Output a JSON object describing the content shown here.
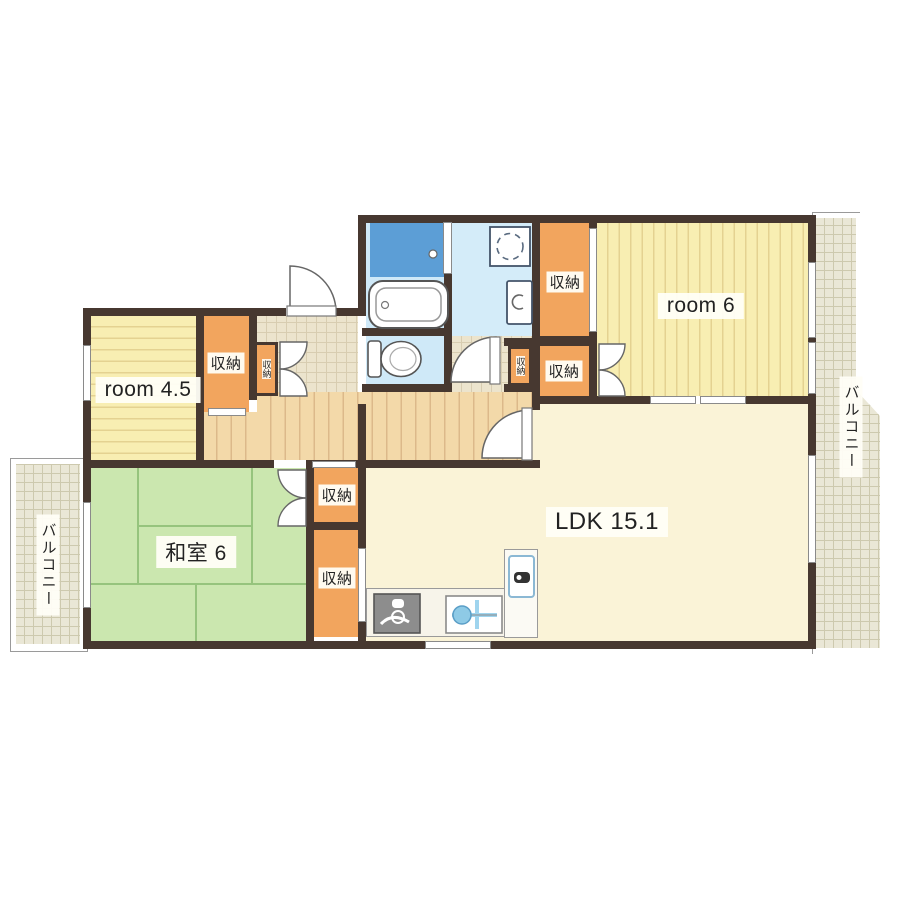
{
  "rooms": {
    "room_45": "room 4.5",
    "room_6": "room 6",
    "washitsu": "和室 6",
    "ldk": "LDK 15.1"
  },
  "storage": "収納",
  "storage_vertical": "収納",
  "balcony": "バルコニー",
  "fixtures": {
    "bathtub": "bathtub",
    "shower": "shower-panel",
    "toilet": "toilet",
    "washing_machine": "washing-machine",
    "washbasin": "washbasin",
    "stove": "gas-stove",
    "sink": "kitchen-sink",
    "refrigerator": "refrigerator"
  },
  "colors": {
    "wall": "#473830",
    "storage_orange": "#f2a55e",
    "room_yellow": "#f8eeb2",
    "tatami_green": "#cbe7af",
    "wood_hall": "#f3d9a9",
    "bath_blue": "#5c9ed6",
    "wet_floor_blue": "#cfe9f8",
    "ldk_cream": "#faf3d7",
    "balcony_grey": "#eae7d6"
  }
}
